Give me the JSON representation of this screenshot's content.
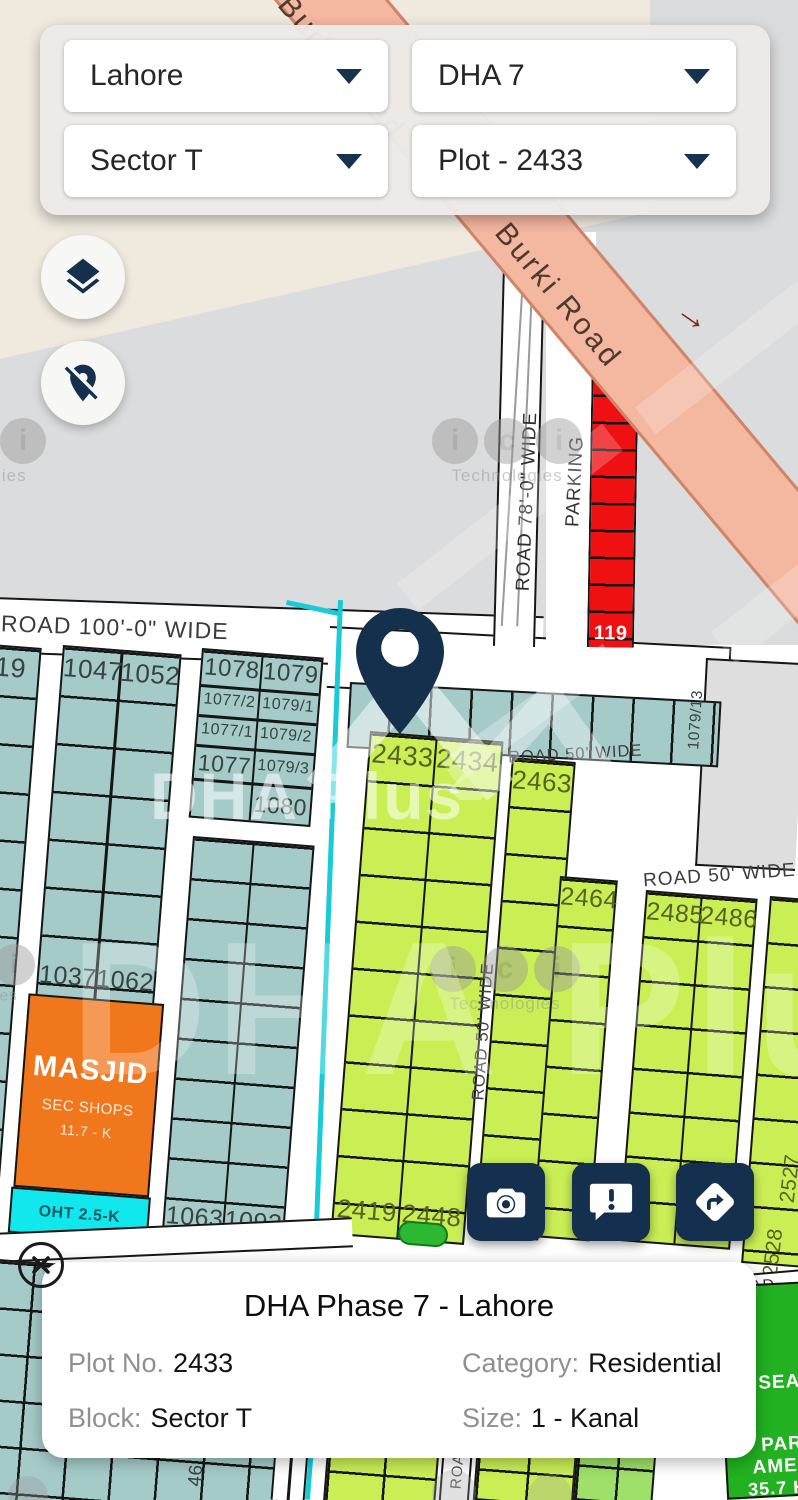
{
  "selector_panel": {
    "city": "Lahore",
    "phase": "DHA 7",
    "sector": "Sector T",
    "plot": "Plot - 2433"
  },
  "info_card": {
    "title": "DHA Phase 7 - Lahore",
    "plot_label": "Plot No.",
    "plot_value": "2433",
    "category_label": "Category:",
    "category_value": "Residential",
    "block_label": "Block:",
    "block_value": "Sector T",
    "size_label": "Size:",
    "size_value": "1 - Kanal"
  },
  "icons": {
    "road_arrow": "→"
  },
  "colors": {
    "navy": "#14304e",
    "teal_plot": "#a5cbc9",
    "yellow_plot": "#c9ef55",
    "red_plot": "#ef1012",
    "orange_masjid": "#f0771b",
    "cyan_oht": "#10e8ee",
    "green_park": "#21b121",
    "salmon_road": "#f4b7a0"
  },
  "map": {
    "roads": {
      "burki": "Burki Road",
      "road100": "ROAD 100'-0\" WIDE",
      "road78": "ROAD 78'-0\" WIDE",
      "parking": "PARKING",
      "road50": "ROAD 50' WIDE",
      "road_fragment": "ROAD"
    },
    "plots": {
      "p1019": "1019",
      "p1047": "1047",
      "p1052": "1052",
      "p1078": "1078",
      "p1079": "1079",
      "p1077_2": "1077/2",
      "p1079_1": "1079/1",
      "p1077_1": "1077/1",
      "p1079_2": "1079/2",
      "p1077": "1077",
      "p1079_3": "1079/3",
      "p1080": "1080",
      "p1079_13": "1079/13",
      "p1037": "1037",
      "p1062": "1062",
      "p1063": "1063",
      "p1093": "1093",
      "p46": "46",
      "p134": "134",
      "p119": "119",
      "p2433": "2433",
      "p2434": "2434",
      "p2463": "2463",
      "p2464": "2464",
      "p2485": "2485",
      "p2486": "2486",
      "p2419": "2419",
      "p2448": "2448",
      "p2527": "2527",
      "p2528": "2528"
    },
    "masjid": {
      "title": "MASJID",
      "sub1": "SEC SHOPS",
      "sub2": "11.7 - K"
    },
    "oht": "OHT 2.5-K",
    "park": {
      "l1": "SEAS",
      "l2": "PARK",
      "l3": "AMEN",
      "l4": "35.7 K"
    },
    "watermarks": {
      "brand": "DHA Plus",
      "tech": "Technologies",
      "la": "i",
      "lb": "c",
      "lc": "i"
    }
  }
}
